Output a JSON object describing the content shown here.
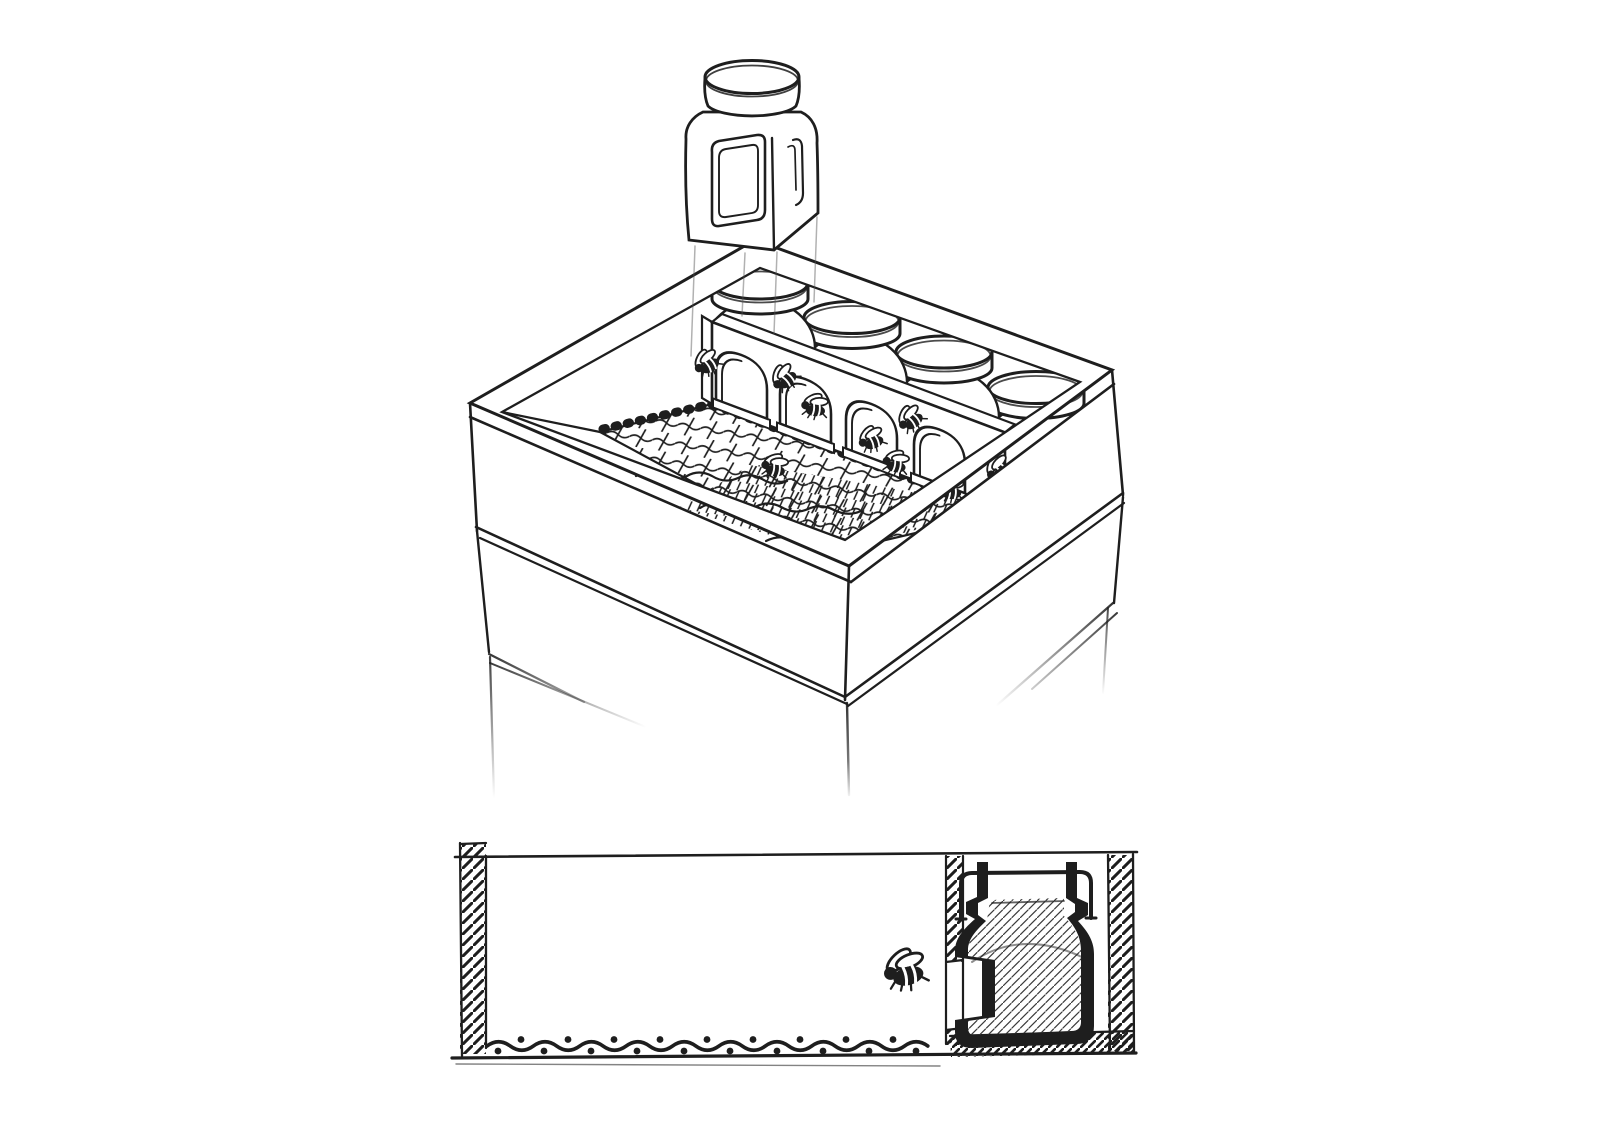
{
  "page": {
    "background_color": "#ffffff",
    "ink_color": "#1e1e1e",
    "description": "Hand-drawn ink diagram of a comb-honey beehive: an open hive super fitted with glass jars above a mesh screen, bees entering through arched gateways in a divider wall, stacked hive boxes below, and a cross-section detail showing a bee entering the jar chamber."
  },
  "top_illustration": {
    "floating_jar_count": 1,
    "seated_jar_lid_count": 4,
    "arch_gateway_count": 4,
    "bee_count": 8,
    "stacked_box_count": 3,
    "mesh_floor": true,
    "guide_line_count": 4
  },
  "cross_section": {
    "jar_count": 1,
    "bee_count": 1,
    "hatched_wall_count": 3,
    "floor_hatched": true,
    "screen_wave_dot_count": 19,
    "entrance_gap": true
  }
}
